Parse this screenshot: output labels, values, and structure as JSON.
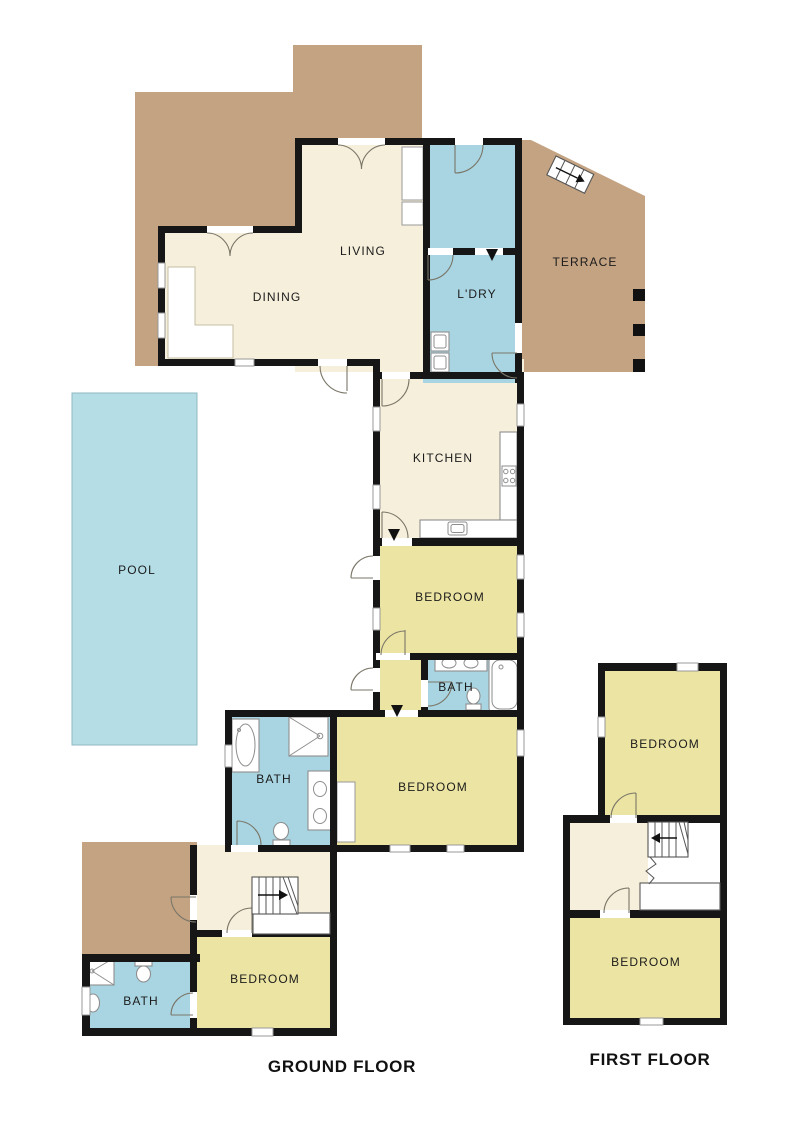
{
  "floorplan": {
    "ground_floor": {
      "title": "GROUND FLOOR",
      "rooms": {
        "living": "LIVING",
        "dining": "DINING",
        "laundry": "L'DRY",
        "terrace": "TERRACE",
        "kitchen": "KITCHEN",
        "pool": "POOL",
        "bedroom_mid": "BEDROOM",
        "bath_ensuite": "BATH",
        "bedroom_main": "BEDROOM",
        "bath_main": "BATH",
        "bedroom_rear": "BEDROOM",
        "bath_rear": "BATH"
      }
    },
    "first_floor": {
      "title": "FIRST FLOOR",
      "rooms": {
        "bedroom_north": "BEDROOM",
        "bedroom_south": "BEDROOM"
      }
    },
    "colors": {
      "deck": "#c4a382",
      "living_area": "#f6efdb",
      "wet_area": "#a9d5e2",
      "pool": "#b4dde6",
      "bedroom": "#ece4a3",
      "wall": "#161616"
    }
  }
}
